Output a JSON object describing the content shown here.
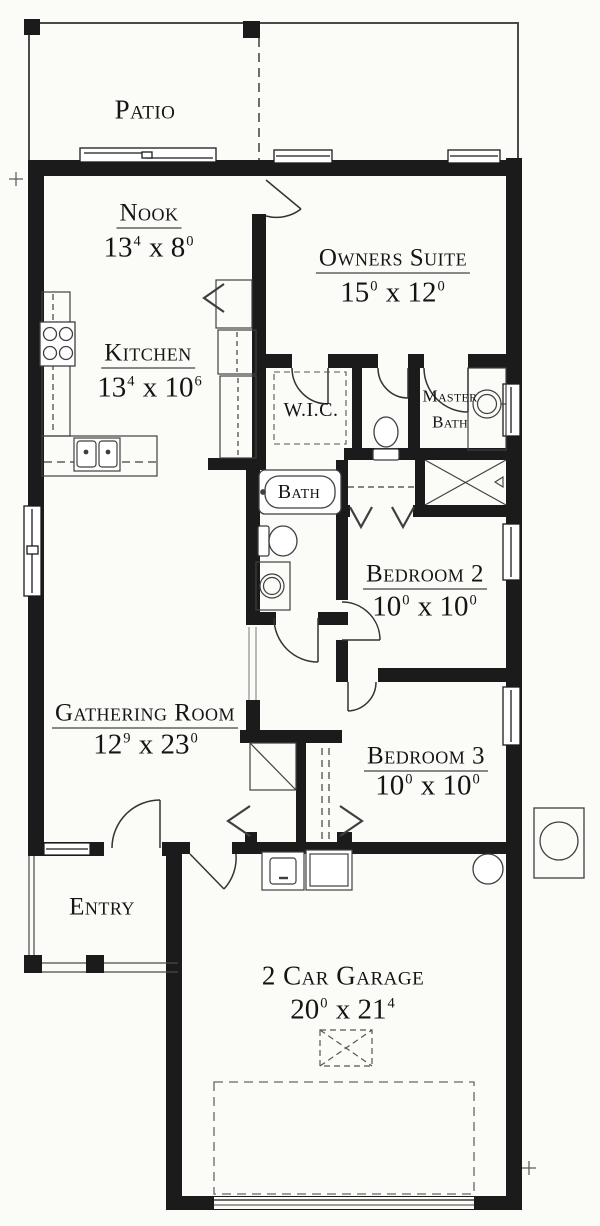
{
  "drawing": {
    "type": "residential-floor-plan",
    "colors": {
      "wall": "#1b1b1b",
      "line": "#383838",
      "dash": "#555555",
      "paper": "#fbfbf8"
    },
    "rooms": {
      "patio": {
        "name": "Patio"
      },
      "nook": {
        "name": "Nook",
        "dim": [
          "13",
          "4",
          "  x  8",
          "0"
        ]
      },
      "owners_suite": {
        "name": "Owners Suite",
        "dim": [
          "15",
          "0",
          "  x  12",
          "0"
        ]
      },
      "kitchen": {
        "name": "Kitchen",
        "dim": [
          "13",
          "4",
          "  x  10",
          "6"
        ]
      },
      "wic": {
        "name": "W.I.C."
      },
      "master_bath": {
        "line1": "Master",
        "line2": "Bath"
      },
      "bath": {
        "name": "Bath"
      },
      "bedroom2": {
        "name": "Bedroom 2",
        "dim": [
          "10",
          "0",
          "  x  10",
          "0"
        ]
      },
      "gathering_room": {
        "name": "Gathering Room",
        "dim": [
          "12",
          "9",
          "  x  23",
          "0"
        ]
      },
      "bedroom3": {
        "name": "Bedroom 3",
        "dim": [
          "10",
          "0",
          "  x  10",
          "0"
        ]
      },
      "entry": {
        "name": "Entry"
      },
      "garage": {
        "name": "2 Car Garage",
        "dim": [
          "20",
          "0",
          "  x  21",
          "4"
        ]
      }
    },
    "fixtures": [
      "range-burners",
      "kitchen-double-sink",
      "pantry-cabinets",
      "nook-closet",
      "wic-shelving",
      "water-closet-toilet",
      "master-vanity-sink",
      "master-shower",
      "bathtub",
      "hall-toilet",
      "hall-vanity-sink",
      "bedroom2-closet-shelf",
      "linen-closet",
      "bedroom3-closet",
      "washer",
      "dryer",
      "water-heater",
      "ac-condenser",
      "attic-access",
      "garage-door",
      "porch-columns"
    ]
  }
}
